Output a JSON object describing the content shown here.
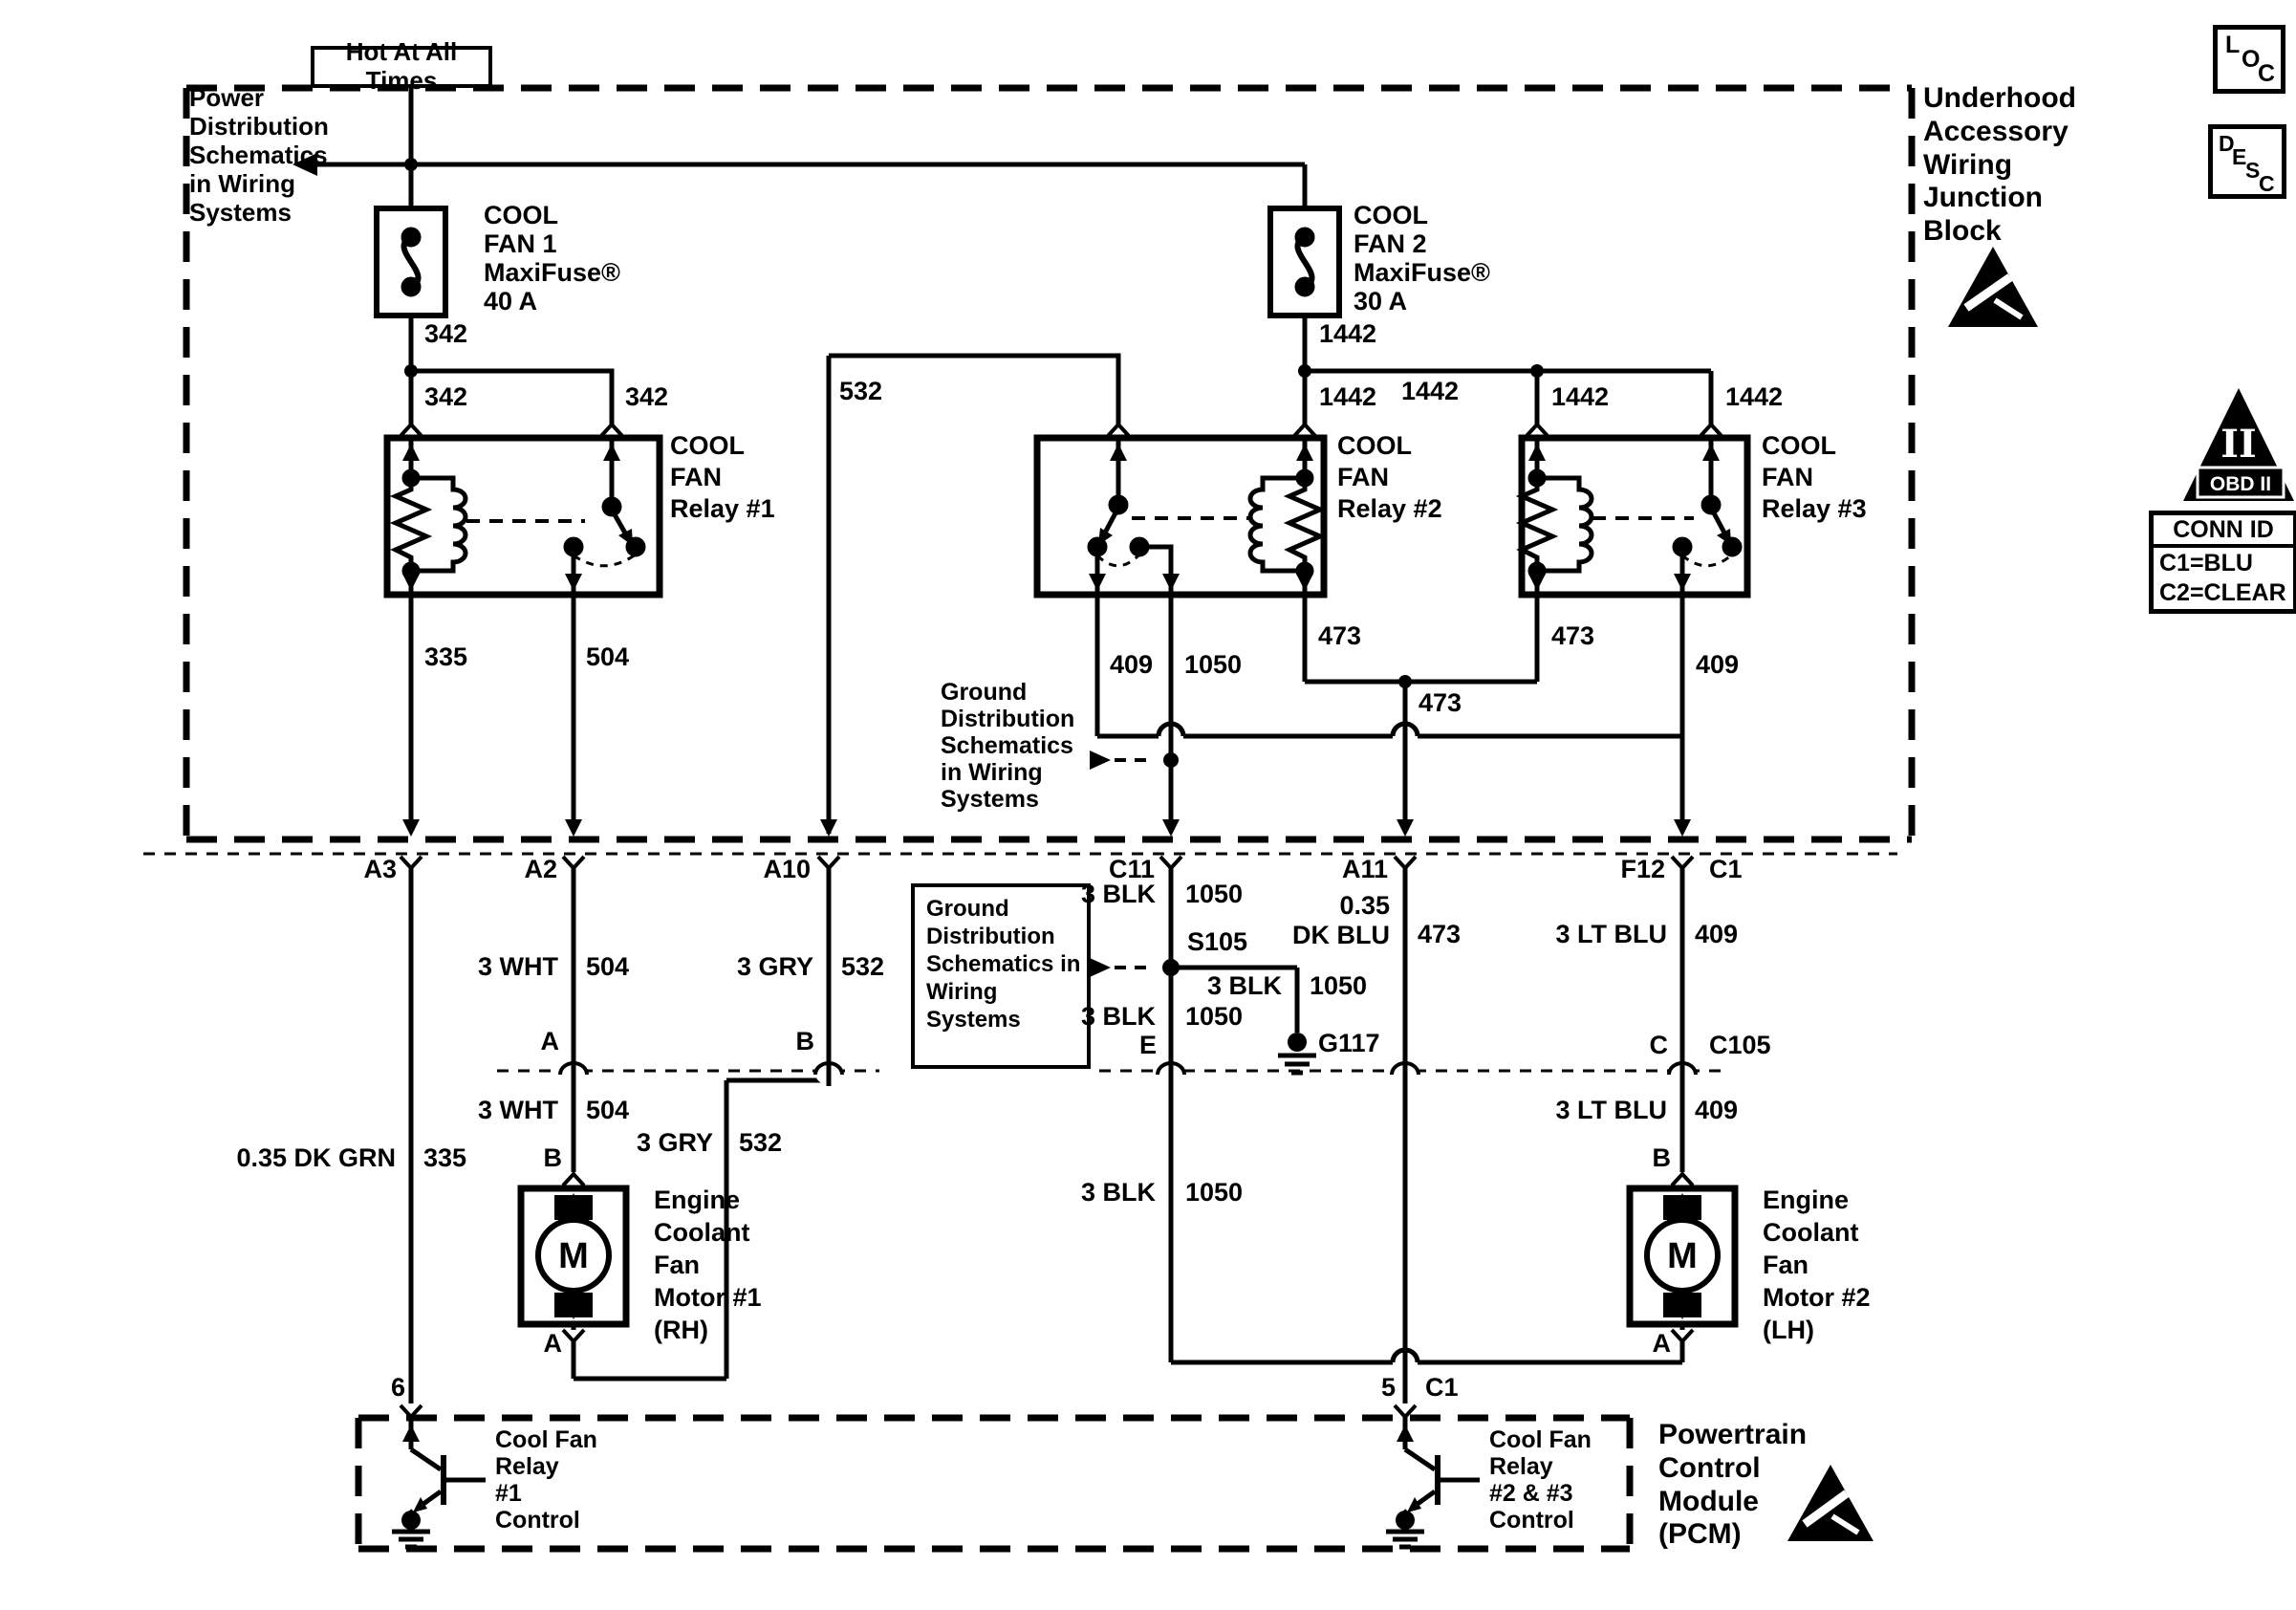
{
  "header": {
    "hot_label": "Hot At All Times",
    "loc_letters": [
      "L",
      "O",
      "C"
    ],
    "desc_letters": [
      "D",
      "E",
      "S",
      "C"
    ]
  },
  "badges": {
    "obd_pillar": "II",
    "obd_label": "OBD II",
    "conn_id": {
      "title": "CONN ID",
      "rows": [
        "C1=BLU",
        "C2=CLEAR"
      ]
    }
  },
  "sections": {
    "junction_block_title": "Underhood\nAccessory\nWiring\nJunction\nBlock",
    "pcm_title": "Powertrain\nControl\nModule\n(PCM)"
  },
  "notes": {
    "power": "Power\nDistribution\nSchematics\nin Wiring\nSystems",
    "ground1": "Ground\nDistribution\nSchematics\nin Wiring\nSystems",
    "ground2": "Ground\nDistribution\nSchematics\nin Wiring\nSystems"
  },
  "fuses": {
    "fan1": "COOL\nFAN 1\nMaxiFuse®\n40 A",
    "fan2": "COOL\nFAN 2\nMaxiFuse®\n30 A"
  },
  "relays": {
    "r1": "COOL\nFAN\nRelay #1",
    "r2": "COOL\nFAN\nRelay #2",
    "r3": "COOL\nFAN\nRelay #3"
  },
  "motors": {
    "m_symbol": "M",
    "m1": "Engine\nCoolant\nFan\nMotor #1\n(RH)",
    "m2": "Engine\nCoolant\nFan\nMotor #2\n(LH)"
  },
  "pcm": {
    "driver1": "Cool Fan\nRelay\n#1\nControl",
    "driver2": "Cool Fan\nRelay\n#2 & #3\nControl",
    "pin6": "6",
    "pin5": "5",
    "pin5_conn": "C1"
  },
  "wire_numbers": {
    "n342_fuse": "342",
    "n342_left": "342",
    "n342_right": "342",
    "n532_top": "532",
    "n1442_fuse": "1442",
    "n1442_relay2": "1442",
    "n1442_mid": "1442",
    "n1442_r3coil": "1442",
    "n1442_r3sw": "1442",
    "n335": "335",
    "n504": "504",
    "n409_left": "409",
    "n409_right": "409",
    "n1050_mid": "1050",
    "n473_left": "473",
    "n473_right": "473",
    "n473_mid": "473"
  },
  "connectors": {
    "a3": "A3",
    "a2": "A2",
    "a10": "A10",
    "c11": "C11",
    "a11": "A11",
    "f12": "F12",
    "c1": "C1",
    "c105": "C105",
    "pin_a": "A",
    "pin_b": "B",
    "pin_e": "E",
    "pin_c": "C",
    "m1_b": "B",
    "m1_a": "A",
    "m2_b": "B",
    "m2_a": "A",
    "s105": "S105",
    "g117": "G117"
  },
  "wire_labels": {
    "wht_504_u": {
      "color": "3 WHT",
      "num": "504"
    },
    "wht_504_l": {
      "color": "3 WHT",
      "num": "504"
    },
    "gry_532_u": {
      "color": "3 GRY",
      "num": "532"
    },
    "gry_532_l": {
      "color": "3 GRY",
      "num": "532"
    },
    "blk_1050_u": {
      "color": "3 BLK",
      "num": "1050"
    },
    "blk_1050_m": {
      "color": "3 BLK",
      "num": "1050"
    },
    "blk_1050_branch": {
      "color": "3 BLK",
      "num": "1050"
    },
    "blk_1050_l": {
      "color": "3 BLK",
      "num": "1050"
    },
    "dkblu_473": {
      "color": "0.35\nDK BLU",
      "num": "473"
    },
    "ltblu_409_u": {
      "color": "3 LT BLU",
      "num": "409"
    },
    "ltblu_409_l": {
      "color": "3 LT BLU",
      "num": "409"
    },
    "dkgrn_335": {
      "color": "0.35 DK GRN",
      "num": "335"
    }
  }
}
